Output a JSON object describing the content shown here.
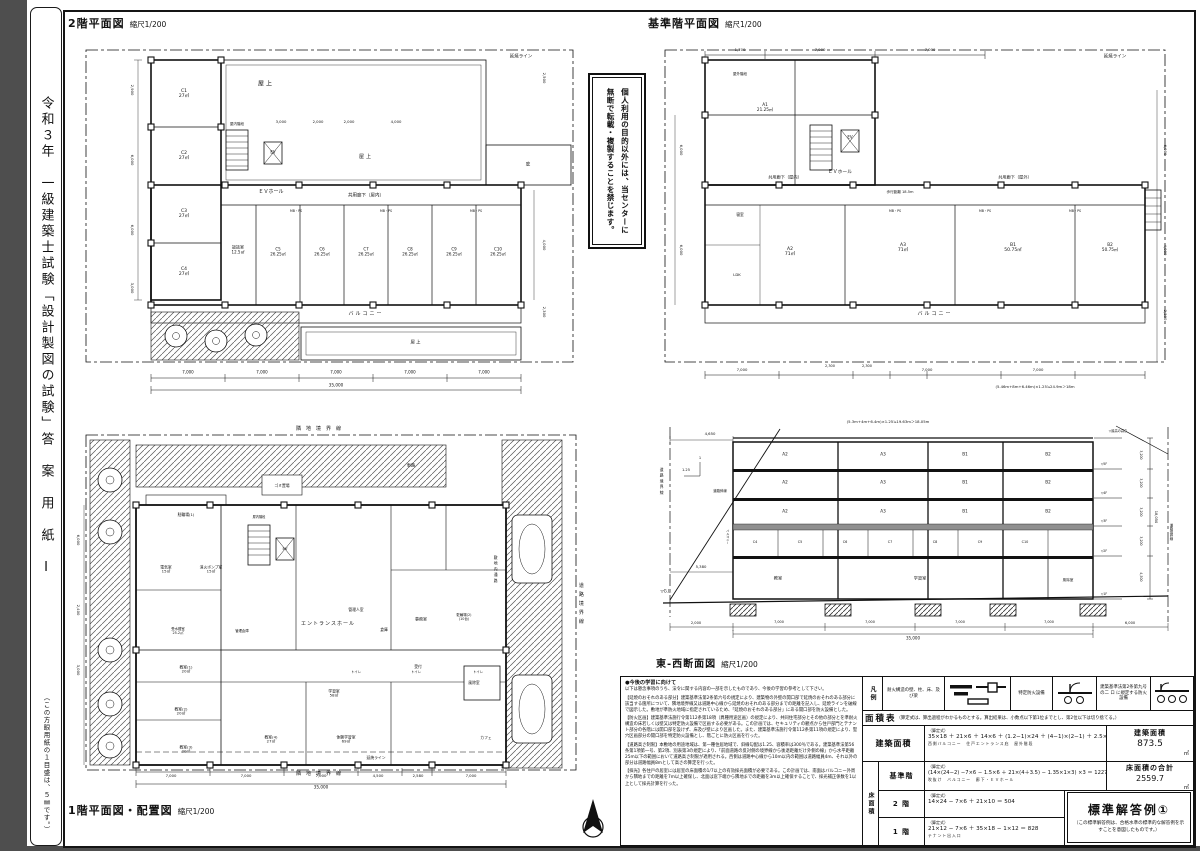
{
  "page": {
    "strip_title": "令和３年　一級建築士試験「設計製図の試験」答　案　用　紙　Ⅰ",
    "strip_note": "（この方眼用紙の１目盛は、５㎜です。）"
  },
  "notice": {
    "line1": "個人利用の目的以外には、当センターに",
    "line2": "無断で転載・複製することを禁じます。"
  },
  "plan2f": {
    "title": "2階平面図",
    "scale": "縮尺1/200",
    "labels": [
      {
        "t": "延焼ライン",
        "x": 455,
        "y": 27,
        "fs": 4.5
      },
      {
        "t": "屋上",
        "x": 200,
        "y": 55,
        "fs": 6,
        "ls": 2
      },
      {
        "t": "屋上",
        "x": 300,
        "y": 128,
        "fs": 5,
        "ls": 2
      },
      {
        "t": "庇",
        "x": 462,
        "y": 135,
        "fs": 4.5
      },
      {
        "t": "EV",
        "x": 207,
        "y": 123,
        "fs": 4
      },
      {
        "t": "ＥＶホール",
        "x": 205,
        "y": 163,
        "fs": 5
      },
      {
        "t": "屋内階段",
        "x": 171,
        "y": 94,
        "fs": 3.5
      },
      {
        "t": "C1\n27㎡",
        "x": 118,
        "y": 64,
        "fs": 4.5
      },
      {
        "t": "C2\n27㎡",
        "x": 118,
        "y": 126,
        "fs": 4.5
      },
      {
        "t": "C3\n27㎡",
        "x": 118,
        "y": 184,
        "fs": 4.5
      },
      {
        "t": "C4\n27㎡",
        "x": 118,
        "y": 242,
        "fs": 4.5
      },
      {
        "t": "談話室\n12.5㎡",
        "x": 172,
        "y": 220,
        "fs": 4
      },
      {
        "t": "C5\n26.25㎡",
        "x": 212,
        "y": 222,
        "fs": 4
      },
      {
        "t": "C6\n26.25㎡",
        "x": 256,
        "y": 222,
        "fs": 4
      },
      {
        "t": "C7\n26.25㎡",
        "x": 300,
        "y": 222,
        "fs": 4
      },
      {
        "t": "C8\n26.25㎡",
        "x": 344,
        "y": 222,
        "fs": 4
      },
      {
        "t": "C9\n26.25㎡",
        "x": 388,
        "y": 222,
        "fs": 4
      },
      {
        "t": "C10\n26.25㎡",
        "x": 432,
        "y": 222,
        "fs": 4
      },
      {
        "t": "共用廊下（屋内）",
        "x": 300,
        "y": 166,
        "fs": 4.5
      },
      {
        "t": "バルコニー",
        "x": 300,
        "y": 285,
        "fs": 5,
        "ls": 2
      },
      {
        "t": "屋上",
        "x": 350,
        "y": 313,
        "fs": 4.5,
        "ls": 1
      },
      {
        "t": "MB・PS",
        "x": 230,
        "y": 182,
        "fs": 3.2
      },
      {
        "t": "MB・PS",
        "x": 320,
        "y": 182,
        "fs": 3.2
      },
      {
        "t": "MB・PS",
        "x": 410,
        "y": 182,
        "fs": 3.2
      },
      {
        "t": "3,000",
        "x": 215,
        "y": 92,
        "fs": 3.8
      },
      {
        "t": "2,000",
        "x": 252,
        "y": 92,
        "fs": 3.8
      },
      {
        "t": "2,000",
        "x": 283,
        "y": 92,
        "fs": 3.8
      },
      {
        "t": "4,000",
        "x": 330,
        "y": 92,
        "fs": 3.8
      },
      {
        "t": "7,000",
        "x": 122,
        "y": 343,
        "fs": 4
      },
      {
        "t": "7,000",
        "x": 196,
        "y": 343,
        "fs": 4
      },
      {
        "t": "7,000",
        "x": 270,
        "y": 343,
        "fs": 4
      },
      {
        "t": "7,000",
        "x": 344,
        "y": 343,
        "fs": 4
      },
      {
        "t": "7,000",
        "x": 418,
        "y": 343,
        "fs": 4
      },
      {
        "t": "35,000",
        "x": 270,
        "y": 356,
        "fs": 4.2
      },
      {
        "t": "2,900",
        "x": 66,
        "y": 60,
        "fs": 3.8,
        "v": 1
      },
      {
        "t": "6,000",
        "x": 66,
        "y": 130,
        "fs": 3.8,
        "v": 1
      },
      {
        "t": "6,000",
        "x": 66,
        "y": 200,
        "fs": 3.8,
        "v": 1
      },
      {
        "t": "3,000",
        "x": 66,
        "y": 258,
        "fs": 3.8,
        "v": 1
      },
      {
        "t": "2,500",
        "x": 478,
        "y": 48,
        "fs": 3.8,
        "v": 1
      },
      {
        "t": "4,000",
        "x": 478,
        "y": 215,
        "fs": 3.8,
        "v": 1
      },
      {
        "t": "2,300",
        "x": 478,
        "y": 282,
        "fs": 3.8,
        "v": 1
      }
    ]
  },
  "planstd": {
    "title": "基準階平面図",
    "scale": "縮尺1/200",
    "labels": [
      {
        "t": "延焼ライン",
        "x": 470,
        "y": 27,
        "fs": 4.5
      },
      {
        "t": "A1\n21.25㎡",
        "x": 120,
        "y": 78,
        "fs": 4.2
      },
      {
        "t": "屋外階段",
        "x": 95,
        "y": 44,
        "fs": 3.5
      },
      {
        "t": "EV",
        "x": 205,
        "y": 108,
        "fs": 4
      },
      {
        "t": "ＥＶホール",
        "x": 195,
        "y": 143,
        "fs": 4.8
      },
      {
        "t": "共用廊下（屋内）",
        "x": 140,
        "y": 148,
        "fs": 4.2
      },
      {
        "t": "共用廊下（屋外）",
        "x": 370,
        "y": 148,
        "fs": 4.2
      },
      {
        "t": "歩行距離 18.5m",
        "x": 255,
        "y": 162,
        "fs": 3.6
      },
      {
        "t": "寝室",
        "x": 95,
        "y": 185,
        "fs": 3.8
      },
      {
        "t": "LDK",
        "x": 92,
        "y": 245,
        "fs": 3.8
      },
      {
        "t": "A2\n71㎡",
        "x": 145,
        "y": 222,
        "fs": 4.5
      },
      {
        "t": "A3\n71㎡",
        "x": 258,
        "y": 218,
        "fs": 4.5
      },
      {
        "t": "B1\n50.75㎡",
        "x": 368,
        "y": 218,
        "fs": 4.5
      },
      {
        "t": "B2\n50.75㎡",
        "x": 465,
        "y": 218,
        "fs": 4.2
      },
      {
        "t": "バルコニー",
        "x": 290,
        "y": 285,
        "fs": 5,
        "ls": 2
      },
      {
        "t": "MB・PS",
        "x": 250,
        "y": 182,
        "fs": 3.2
      },
      {
        "t": "MB・PS",
        "x": 340,
        "y": 182,
        "fs": 3.2
      },
      {
        "t": "MB・PS",
        "x": 430,
        "y": 182,
        "fs": 3.2
      },
      {
        "t": "1,700",
        "x": 95,
        "y": 20,
        "fs": 3.8
      },
      {
        "t": "7,000",
        "x": 175,
        "y": 20,
        "fs": 3.8
      },
      {
        "t": "7,000",
        "x": 285,
        "y": 20,
        "fs": 3.8
      },
      {
        "t": "7,000",
        "x": 97,
        "y": 340,
        "fs": 3.8
      },
      {
        "t": "2,300",
        "x": 185,
        "y": 336,
        "fs": 3.5
      },
      {
        "t": "2,300",
        "x": 222,
        "y": 336,
        "fs": 3.5
      },
      {
        "t": "7,000",
        "x": 282,
        "y": 340,
        "fs": 3.8
      },
      {
        "t": "7,000",
        "x": 393,
        "y": 340,
        "fs": 3.8
      },
      {
        "t": "(5.46m+8m+6.46m)×1.25≒24.9m＞18m",
        "x": 390,
        "y": 357,
        "fs": 3.8
      },
      {
        "t": "6,000",
        "x": 520,
        "y": 120,
        "fs": 3.8,
        "v": 1
      },
      {
        "t": "4,000",
        "x": 520,
        "y": 220,
        "fs": 3.8,
        "v": 1
      },
      {
        "t": "2,300",
        "x": 520,
        "y": 285,
        "fs": 3.8,
        "v": 1
      },
      {
        "t": "6,000",
        "x": 36,
        "y": 120,
        "fs": 3.8,
        "v": 1
      },
      {
        "t": "6,000",
        "x": 36,
        "y": 220,
        "fs": 3.8,
        "v": 1
      }
    ]
  },
  "plan1f": {
    "title": "1階平面図・配置図",
    "scale": "縮尺1/200",
    "labels": [
      {
        "t": "隣地境界線",
        "x": 255,
        "y": 10,
        "fs": 5,
        "ls": 5
      },
      {
        "t": "隣地境界線",
        "x": 255,
        "y": 355,
        "fs": 5,
        "ls": 5
      },
      {
        "t": "道路境界線",
        "x": 514,
        "y": 185,
        "fs": 5,
        "v": 1,
        "ls": 4
      },
      {
        "t": "車路",
        "x": 345,
        "y": 46,
        "fs": 4.2
      },
      {
        "t": "ゴミ置場",
        "x": 216,
        "y": 66,
        "fs": 3.8
      },
      {
        "t": "駐輪場(1)",
        "x": 120,
        "y": 95,
        "fs": 3.8
      },
      {
        "t": "電気室\n15㎡",
        "x": 100,
        "y": 150,
        "fs": 3.8
      },
      {
        "t": "消火ポンプ室\n15㎡",
        "x": 145,
        "y": 150,
        "fs": 3.8
      },
      {
        "t": "屋内階段",
        "x": 193,
        "y": 98,
        "fs": 3.2
      },
      {
        "t": "EV",
        "x": 219,
        "y": 129,
        "fs": 3.8
      },
      {
        "t": "エントランスホール",
        "x": 262,
        "y": 205,
        "fs": 5,
        "ls": 1
      },
      {
        "t": "管理人室",
        "x": 290,
        "y": 190,
        "fs": 3.8
      },
      {
        "t": "倉庫",
        "x": 318,
        "y": 210,
        "fs": 3.8
      },
      {
        "t": "事務室",
        "x": 355,
        "y": 200,
        "fs": 4
      },
      {
        "t": "受付",
        "x": 352,
        "y": 247,
        "fs": 3.8
      },
      {
        "t": "管理倉庫",
        "x": 176,
        "y": 212,
        "fs": 3.4
      },
      {
        "t": "受水槽室\n25.2㎡",
        "x": 112,
        "y": 212,
        "fs": 3.4
      },
      {
        "t": "トイレ",
        "x": 290,
        "y": 253,
        "fs": 3.4
      },
      {
        "t": "トイレ",
        "x": 350,
        "y": 253,
        "fs": 3.4
      },
      {
        "t": "トイレ",
        "x": 412,
        "y": 253,
        "fs": 3.4
      },
      {
        "t": "教室(1)\n20㎡",
        "x": 120,
        "y": 250,
        "fs": 3.8
      },
      {
        "t": "教室(2)\n20㎡",
        "x": 115,
        "y": 292,
        "fs": 3.8
      },
      {
        "t": "教室(3)\n20㎡",
        "x": 120,
        "y": 330,
        "fs": 3.8
      },
      {
        "t": "教室(4)\n27㎡",
        "x": 205,
        "y": 320,
        "fs": 3.8
      },
      {
        "t": "体験学習室\n69㎡",
        "x": 280,
        "y": 320,
        "fs": 3.8
      },
      {
        "t": "学習室\n58㎡",
        "x": 268,
        "y": 274,
        "fs": 3.8
      },
      {
        "t": "延焼ライン",
        "x": 310,
        "y": 338,
        "fs": 3.8
      },
      {
        "t": "風除室",
        "x": 408,
        "y": 263,
        "fs": 3.8
      },
      {
        "t": "駐輪場(2)\n(10台)",
        "x": 398,
        "y": 198,
        "fs": 3.4
      },
      {
        "t": "敷地内通路",
        "x": 430,
        "y": 150,
        "fs": 3.8,
        "v": 1,
        "ls": 2
      },
      {
        "t": "カフェ",
        "x": 420,
        "y": 318,
        "fs": 3.8
      },
      {
        "t": "7,000",
        "x": 105,
        "y": 356,
        "fs": 3.8
      },
      {
        "t": "7,000",
        "x": 180,
        "y": 356,
        "fs": 3.8
      },
      {
        "t": "7,000",
        "x": 255,
        "y": 356,
        "fs": 3.8
      },
      {
        "t": "4,500",
        "x": 312,
        "y": 356,
        "fs": 3.8
      },
      {
        "t": "2,580",
        "x": 352,
        "y": 356,
        "fs": 3.8
      },
      {
        "t": "7,000",
        "x": 405,
        "y": 356,
        "fs": 3.8
      },
      {
        "t": "35,000",
        "x": 255,
        "y": 368,
        "fs": 4.2
      },
      {
        "t": "6,000",
        "x": 12,
        "y": 120,
        "fs": 3.8,
        "v": 1
      },
      {
        "t": "2,400",
        "x": 12,
        "y": 190,
        "fs": 3.8,
        "v": 1
      },
      {
        "t": "3,000",
        "x": 12,
        "y": 250,
        "fs": 3.8,
        "v": 1
      }
    ]
  },
  "section": {
    "title": "東-西断面図",
    "scale": "縮尺1/200",
    "labels": [
      {
        "t": "(5.3m+4m+6.4m)×1.25≒19.63m＞18.05m",
        "x": 240,
        "y": 10,
        "fs": 3.8
      },
      {
        "t": "道路境界線",
        "x": 14,
        "y": 70,
        "fs": 3.8,
        "v": 1,
        "ls": 2
      },
      {
        "t": "道路斜線",
        "x": 72,
        "y": 80,
        "fs": 3.4
      },
      {
        "t": "1.25",
        "x": 38,
        "y": 58,
        "fs": 3.6
      },
      {
        "t": "1",
        "x": 52,
        "y": 46,
        "fs": 3.6
      },
      {
        "t": "4,650",
        "x": 62,
        "y": 22,
        "fs": 3.8
      },
      {
        "t": "5,380",
        "x": 53,
        "y": 155,
        "fs": 3.8
      },
      {
        "t": "バルコニー",
        "x": 79,
        "y": 125,
        "fs": 3,
        "v": 1
      },
      {
        "t": "▽G.L.",
        "x": 18,
        "y": 180,
        "fs": 4
      },
      {
        "t": "A2",
        "x": 137,
        "y": 43,
        "fs": 4.2
      },
      {
        "t": "A3",
        "x": 235,
        "y": 43,
        "fs": 4.2
      },
      {
        "t": "B1",
        "x": 317,
        "y": 43,
        "fs": 4.2
      },
      {
        "t": "B2",
        "x": 400,
        "y": 43,
        "fs": 4.2
      },
      {
        "t": "A2",
        "x": 137,
        "y": 71,
        "fs": 4.2
      },
      {
        "t": "A3",
        "x": 235,
        "y": 71,
        "fs": 4.2
      },
      {
        "t": "B1",
        "x": 317,
        "y": 71,
        "fs": 4.2
      },
      {
        "t": "B2",
        "x": 400,
        "y": 71,
        "fs": 4.2
      },
      {
        "t": "A2",
        "x": 137,
        "y": 100,
        "fs": 4.2
      },
      {
        "t": "A3",
        "x": 235,
        "y": 100,
        "fs": 4.2
      },
      {
        "t": "B1",
        "x": 317,
        "y": 100,
        "fs": 4.2
      },
      {
        "t": "B2",
        "x": 400,
        "y": 100,
        "fs": 4.2
      },
      {
        "t": "C4",
        "x": 107,
        "y": 131,
        "fs": 3.4
      },
      {
        "t": "C5",
        "x": 152,
        "y": 131,
        "fs": 3.4
      },
      {
        "t": "C6",
        "x": 197,
        "y": 131,
        "fs": 3.4
      },
      {
        "t": "C7",
        "x": 242,
        "y": 131,
        "fs": 3.4
      },
      {
        "t": "C8",
        "x": 287,
        "y": 131,
        "fs": 3.4
      },
      {
        "t": "C9",
        "x": 332,
        "y": 131,
        "fs": 3.4
      },
      {
        "t": "C10",
        "x": 377,
        "y": 131,
        "fs": 3.4
      },
      {
        "t": "教室",
        "x": 130,
        "y": 167,
        "fs": 4.2
      },
      {
        "t": "学習室",
        "x": 272,
        "y": 167,
        "fs": 4.2
      },
      {
        "t": "風除室",
        "x": 420,
        "y": 168,
        "fs": 3.6
      },
      {
        "t": "▽最高の高さ",
        "x": 470,
        "y": 20,
        "fs": 3.2
      },
      {
        "t": "▽5F",
        "x": 456,
        "y": 53,
        "fs": 3.2
      },
      {
        "t": "▽4F",
        "x": 456,
        "y": 82,
        "fs": 3.2
      },
      {
        "t": "▽3F",
        "x": 456,
        "y": 110,
        "fs": 3.2
      },
      {
        "t": "▽2F",
        "x": 456,
        "y": 140,
        "fs": 3.2
      },
      {
        "t": "▽1F",
        "x": 456,
        "y": 183,
        "fs": 3.2
      },
      {
        "t": "3,200",
        "x": 492,
        "y": 43,
        "fs": 3.2,
        "v": 1
      },
      {
        "t": "3,200",
        "x": 492,
        "y": 71,
        "fs": 3.2,
        "v": 1
      },
      {
        "t": "3,200",
        "x": 492,
        "y": 100,
        "fs": 3.2,
        "v": 1
      },
      {
        "t": "3,200",
        "x": 492,
        "y": 129,
        "fs": 3.2,
        "v": 1
      },
      {
        "t": "4,500",
        "x": 492,
        "y": 165,
        "fs": 3.2,
        "v": 1
      },
      {
        "t": "18,050",
        "x": 508,
        "y": 105,
        "fs": 3.6,
        "v": 1
      },
      {
        "t": "道路境界線",
        "x": 522,
        "y": 120,
        "fs": 3.4,
        "v": 1
      },
      {
        "t": "2,000",
        "x": 48,
        "y": 211,
        "fs": 3.6
      },
      {
        "t": "7,000",
        "x": 131,
        "y": 211,
        "fs": 3.4
      },
      {
        "t": "7,000",
        "x": 222,
        "y": 211,
        "fs": 3.4
      },
      {
        "t": "7,000",
        "x": 312,
        "y": 211,
        "fs": 3.4
      },
      {
        "t": "7,000",
        "x": 401,
        "y": 211,
        "fs": 3.4
      },
      {
        "t": "6,000",
        "x": 482,
        "y": 211,
        "fs": 3.6
      },
      {
        "t": "35,000",
        "x": 265,
        "y": 227,
        "fs": 4
      }
    ]
  },
  "notes": {
    "heading": "●今後の学習に向けて",
    "intro": "以下は懸念事項のうち、法令に関する内容の一部を示したものであり、今後の学習の参考として下さい。",
    "paragraphs": [
      "【延焼のおそれのある部分】建築基準法第2条第六号の規定により、建築物の外壁の開口部で延焼のおそれのある部分に該当する箇所について、隣地境界線又は道路中心線から延焼のおそれのある部分までの距離を記入し、延焼ラインを破線で図示した。敷地が準防火地域に指定されているため、「延焼のおそれのある部分」にある開口部を防火設備とした。",
      "【防火区画】建築基準法施行令第112条第18項（異種用途区画）の規定により、共同住宅部分とその他の部分とを準耐火構造の床若しくは壁又は特定防火設備で区画する必要がある。この計画では、セキュリティの観点から住戸部門とテナント部分の各階には開口部を設けず、床及び壁により区画した。また、建築基準法施行令第112条第11項の規定により、竪穴区画部分の開口部を特定防火設備とし、階ごとに防火区画を行った。",
      "【道路高さ制限】本敷地の用途地域は、第一種住居地域で、斜線勾配は1.25、容積率は300％である。建築基準法第56条第1項第一号、第2項、別表第3の規定により、「前面道路の反対側の境界線から後退距離だけ外側の線」から水平距離25m以下の範囲において道路高さ制限が適用される。西側は道路中心線から10m以内の範囲は道路幅員4m、それ以外の部分は道路幅員8mとして高さの算定を行った。",
      "【採光】各住戸の居室には居室の床面積の1/7以上の有効採光面積が必要である。この計画では、南面はバルコニー外周から隣地までの距離を7m以上確保し、北面は窓下端から隣地までの距離を3m以上確保することで、採光補正係数を1以上として採光計算を行った。"
    ]
  },
  "legend": {
    "label": "凡例",
    "item1": "耐火構造の壁、柱、床、及び梁",
    "item2": "特定防火設備",
    "item3": "建築基準法第2条第九号の二 ロ に規定する防火設備"
  },
  "area_table": {
    "title": "面積表",
    "title_note": "（算定式は、算出過程がわかるものとする。算出結果は、小数点以下第1位までとし、第2位以下は切り捨てる。）",
    "yuka_label": "床面積",
    "formula_label": "（算定式）",
    "rows": {
      "kenchiku": {
        "label": "建築面積",
        "formula": "35×18 ＋ 21×6 ＋ 14×6 ＋ (1.2−1)×24 ＋ (4−1)×(2−1) ＋ 2.5×5.5 ＝ 873.55",
        "anno": "西側バルコニー　住戸エントランス庇　屋外階段",
        "result_label": "建築面積",
        "result_value": "873.5",
        "unit": "㎡"
      },
      "kijun": {
        "label": "基準階",
        "formula": "(14×(24−2) −7×6 − 1.5×6 ＋ 21×(4＋3.5) − 1.35×1×3) ×3 ＝ 1227.75",
        "anno": "吹抜け　バルコニー　廊下・ＥＶホール",
        "result_label": "床面積の合計",
        "result_value": "2559.7",
        "unit": "㎡"
      },
      "floor2": {
        "label": "2 階",
        "formula": "14×24 − 7×6 ＋ 21×10 ＝ 504",
        "anno": ""
      },
      "floor1": {
        "label": "1 階",
        "formula": "21×12 − 7×6 ＋ 35×18 − 1×12 ＝ 828",
        "anno": "テナント出入口"
      }
    }
  },
  "badge": {
    "title": "標準解答例①",
    "note": "（この標準解答例は、合格水準の標準的な解答例を示すことを意図したものです。）"
  }
}
